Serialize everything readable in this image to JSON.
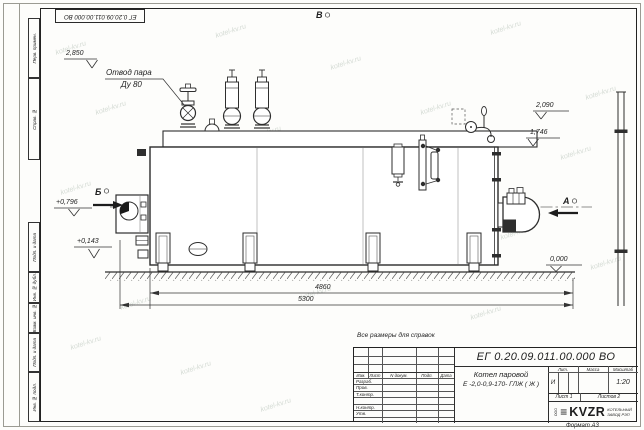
{
  "doc_number": "ЕГ 0.20.09.011.00.000 ВО",
  "frame": {
    "margin_labels": [
      "Перв. примен.",
      "Справ. №",
      "Подп. и дата",
      "Инв. № дубл.",
      "Взам. инв. №",
      "Подп. и дата",
      "Инв. № подл."
    ],
    "format_label": "Формат А3"
  },
  "drawing": {
    "note": "Все размеры для справок",
    "watermark": "kotel-kv.ru",
    "steam_outlet_label_line1": "Отвод пара",
    "steam_outlet_label_line2": "Ду 80",
    "view_marks": {
      "a": "А",
      "b": "Б",
      "v": "В"
    },
    "elevations": {
      "steam": "2,850",
      "right_upper": "2,090",
      "right_lower": "1,746",
      "left_upper": "+0,796",
      "left_lower": "+0,143",
      "ground": "0,000"
    },
    "dimensions": {
      "length_feet": "4860",
      "length_overall": "5300"
    }
  },
  "title_block": {
    "product_name_line1": "Котел паровой",
    "product_name_line2": "Е -2,0-0,9-170- ГЛЖ ( Ж )",
    "header_cols": [
      "Изм.",
      "Лист",
      "N докум.",
      "Подп.",
      "Дата"
    ],
    "sign_rows": [
      "Разраб.",
      "Пров.",
      "Т.контр.",
      "",
      "Н.контр.",
      "Утв.",
      ""
    ],
    "lit_label": "Лит.",
    "mass_label": "Масса",
    "scale_label": "Масштаб",
    "lit_value": "И",
    "scale_value": "1:20",
    "sheet_info": "Лист 1",
    "sheets_info": "Листов 2",
    "logo_prefix": "ООО",
    "logo_bars": "≡",
    "logo_text": "KVZR",
    "company_line1": "КОТЕЛЬНЫЙ",
    "company_line2": "ЗАВОД РЭП"
  }
}
